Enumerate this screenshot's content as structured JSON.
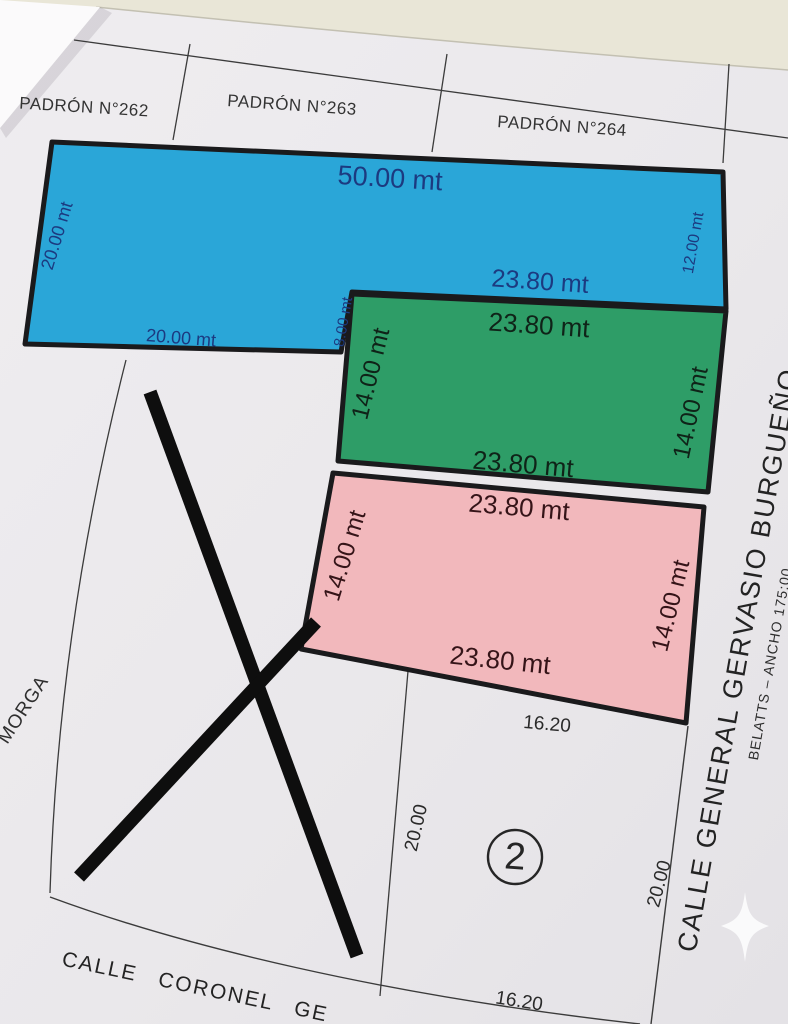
{
  "colors": {
    "background": "#e9e6d7",
    "paper": "#ebe9ec",
    "fold": "#fbfafb",
    "parcel_blue": "#2aa6d8",
    "parcel_green": "#2e9d67",
    "parcel_pink": "#f2b8bc",
    "border_dark": "#1a1a1c",
    "thin_line": "#3b3b3b",
    "label_blue": "#1c3a80",
    "label_green": "#0f2318",
    "label_pink": "#351418",
    "ink": "#333333",
    "marker_x": "#0e0e0e"
  },
  "padron_strip": {
    "cells": [
      {
        "label": "PADRÓN N°262"
      },
      {
        "label": "PADRÓN N°263"
      },
      {
        "label": "PADRÓN N°264"
      }
    ]
  },
  "parcels": {
    "blue": {
      "top_width": "50.00 mt",
      "left_depth": "20.00 mt",
      "right_depth": "12.00 mt",
      "inner_width": "23.80 mt",
      "bottom_width": "20.00 mt",
      "step": "8.00 mt"
    },
    "green": {
      "top_width": "23.80 mt",
      "left_depth": "14.00 mt",
      "right_depth": "14.00 mt",
      "bottom_width": "23.80 mt"
    },
    "pink": {
      "top_width": "23.80 mt",
      "left_depth": "14.00 mt",
      "right_depth": "14.00 mt",
      "bottom_width": "23.80 mt"
    }
  },
  "lot2": {
    "number": "2",
    "top_width": "16.20",
    "left_depth": "20.00",
    "right_depth": "20.00",
    "bottom_width": "16.20"
  },
  "streets": {
    "bottom_name": "CALLE CORONEL GE",
    "right_name": "CALLE GENERAL GERVASIO BURGUEÑO",
    "right_note": "BELATTS – ANCHO 175:00"
  },
  "neighbor_label": "MORGA"
}
